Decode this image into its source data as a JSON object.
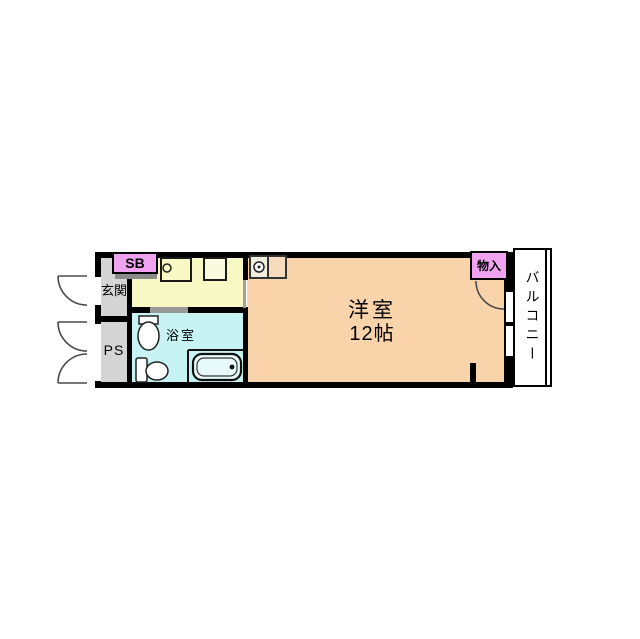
{
  "rooms": {
    "entrance": {
      "label": "玄関"
    },
    "pipe_space": {
      "label": "PS"
    },
    "shoe_box": {
      "label": "SB"
    },
    "bathroom": {
      "label": "浴室"
    },
    "main_room": {
      "label": "洋室",
      "size_label": "12帖"
    },
    "closet": {
      "label": "物入"
    },
    "balcony": {
      "label": "バルコニー"
    }
  },
  "colors": {
    "wall": "#000000",
    "entrance_fill": "#d5d5d5",
    "kitchen_fill": "#f9f9c5",
    "bathroom_fill": "#c8f3f5",
    "room_fill": "#f9d4ab",
    "pink_fill": "#efa3f0",
    "balcony_fill": "#ffffff",
    "door_marker": "#999999",
    "sb_bar": "#8a8a8a",
    "opening_line": "#a0a0a0",
    "unit_left": "#f2eedd",
    "unit_right": "#f6dcbc",
    "sink_fill": "#fafae0",
    "tub_fill": "#e8fbfc",
    "arc_stroke": "#4a4a4a",
    "fixture_stroke": "#222222"
  }
}
